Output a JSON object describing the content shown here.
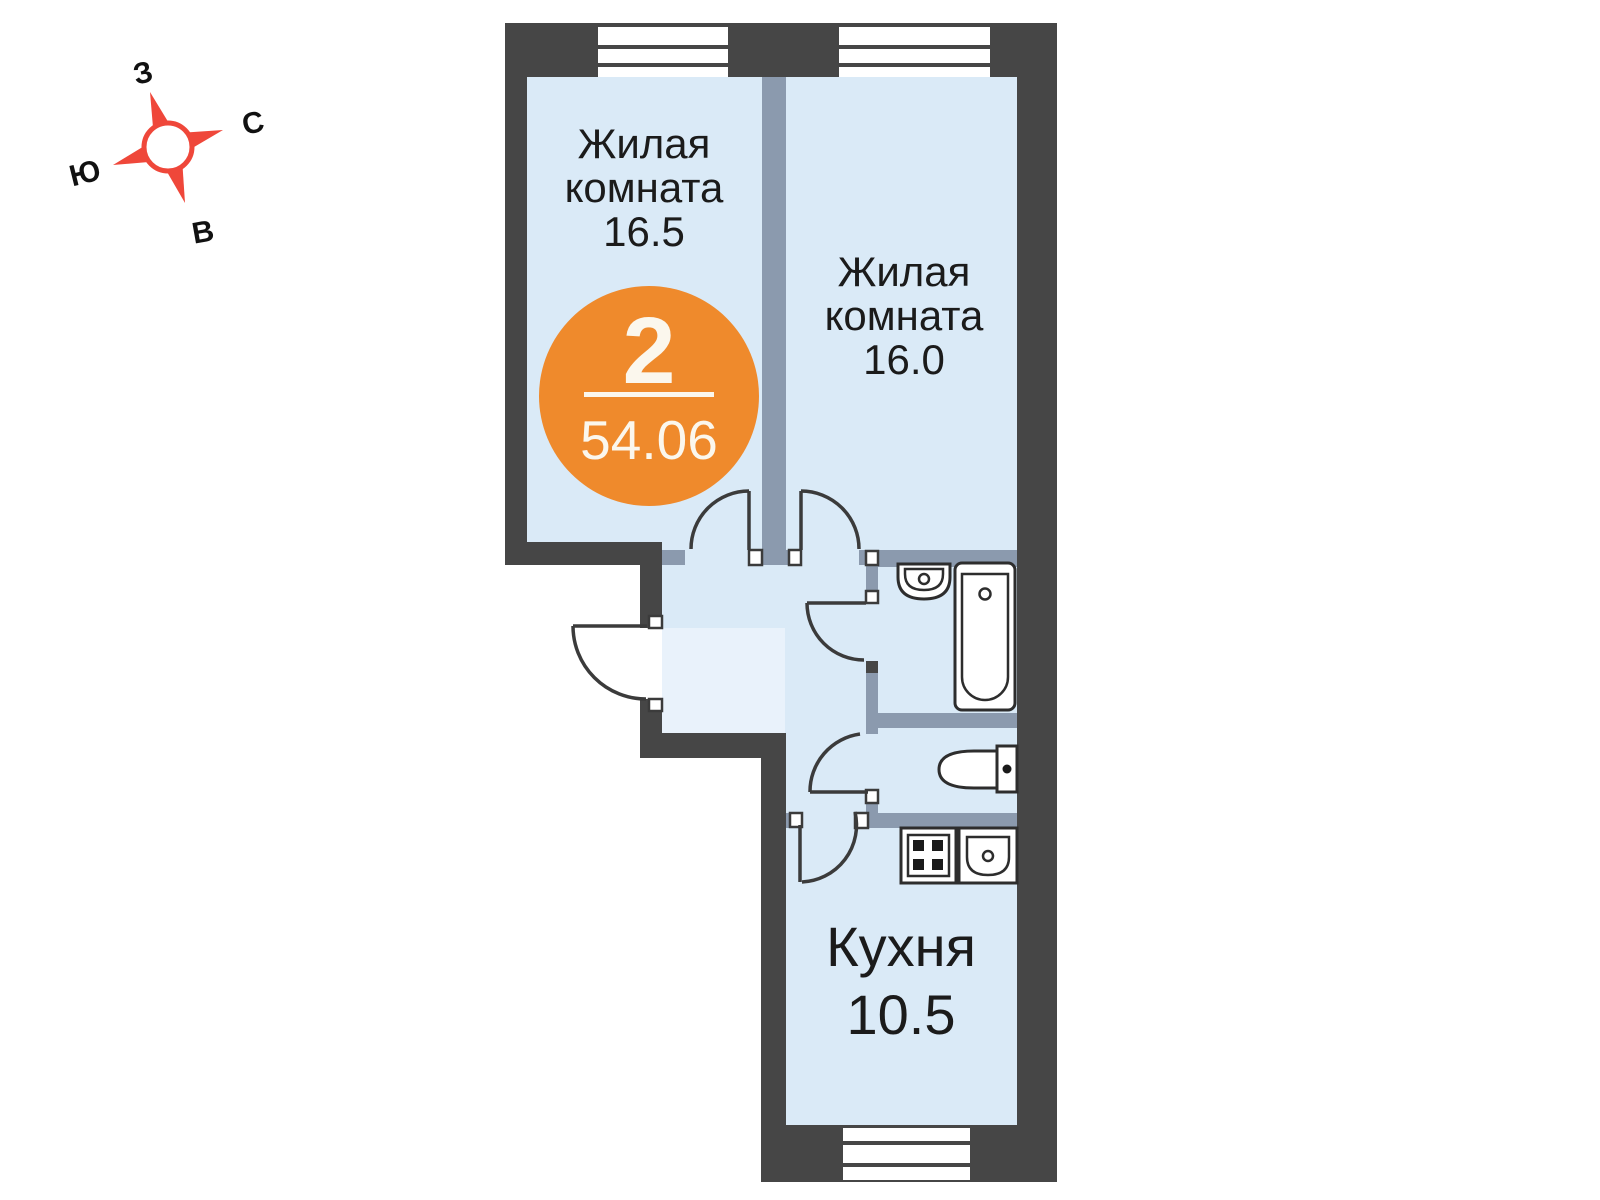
{
  "compass": {
    "west": "З",
    "north": "С",
    "south": "Ю",
    "east": "В"
  },
  "badge": {
    "rooms_count": "2",
    "total_area": "54.06"
  },
  "rooms": [
    {
      "name_line1": "Жилая",
      "name_line2": "комната",
      "area": "16.5"
    },
    {
      "name_line1": "Жилая",
      "name_line2": "комната",
      "area": "16.0"
    }
  ],
  "kitchen": {
    "name": "Кухня",
    "area": "10.5"
  },
  "colors": {
    "wall_dark": "#464646",
    "wall_inner": "#8b9aae",
    "floor": "#daeaf7",
    "floor_entry": "#e9f2fb",
    "accent_orange": "#ef8a2c",
    "compass_red": "#ef473a"
  }
}
